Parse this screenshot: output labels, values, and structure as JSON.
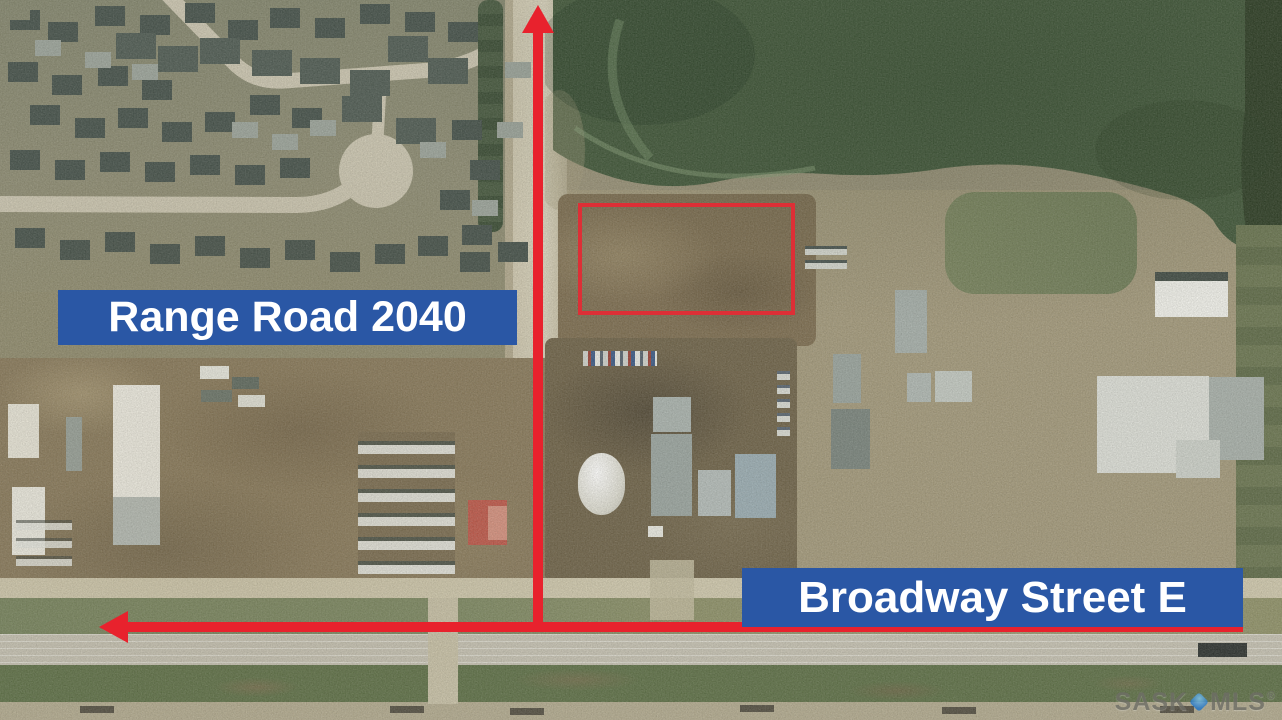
{
  "labels": {
    "range_road": "Range Road 2040",
    "broadway_street": "Broadway Street E"
  },
  "watermark": {
    "part1": "SASK",
    "part2": "MLS",
    "registered": "®"
  },
  "colors": {
    "banner_blue": "#2a57a5",
    "annotation_red": "#e8222d",
    "outline_red": "#dd2f36",
    "watermark_gray": "#6e6e66",
    "pin_blue": "#1e73c8"
  }
}
